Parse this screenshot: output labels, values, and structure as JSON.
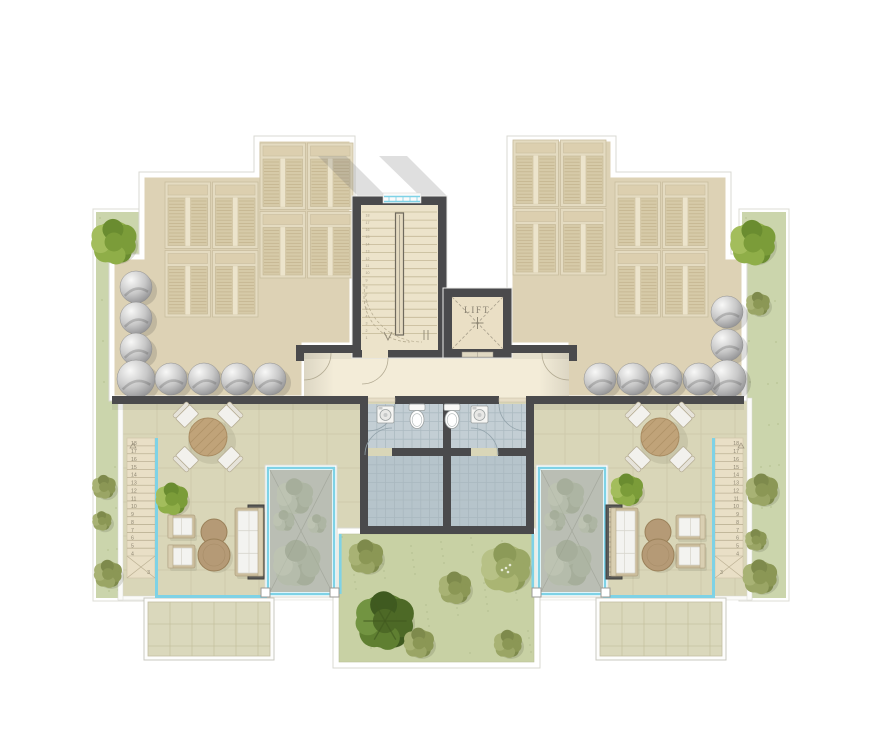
{
  "plan": {
    "lift": {
      "label": "LIFT"
    },
    "stairs": {
      "outer_left_steps": [
        "18",
        "17",
        "16",
        "15",
        "14",
        "13",
        "12",
        "11",
        "10",
        "9",
        "8",
        "7",
        "6",
        "5",
        "4"
      ],
      "outer_left_landing": "3",
      "outer_right_steps": [
        "18",
        "17",
        "16",
        "15",
        "14",
        "13",
        "12",
        "11",
        "10",
        "9",
        "8",
        "7",
        "6",
        "5",
        "4"
      ],
      "outer_right_landing": "3",
      "tower_steps": [
        "1",
        "2",
        "3",
        "4",
        "5",
        "6",
        "7",
        "8",
        "9",
        "10",
        "11",
        "12",
        "13",
        "14",
        "15",
        "16",
        "17",
        "18"
      ]
    },
    "summary": {
      "dome_skylights_left": 8,
      "dome_skylights_right": 7,
      "louver_skylight_clusters": 4,
      "terraces": 2,
      "bathrooms": 2,
      "garden_trees": 6
    }
  },
  "colors": {
    "wall": "#4a4a4c",
    "roof_deck": "#ddd2b5",
    "louver_panel": "#d6caa8",
    "terrace_tile": "#d9d6b8",
    "corridor": "#f3ecd8",
    "stair_tread": "#e9dfc6",
    "grass_strip": "#cbd5ac",
    "grass_garden": "#c8d1a4",
    "bath_tile_upper": "#c3ced4",
    "bath_tile_lower": "#b6c4cb",
    "glass_rail": "#7ed2e6",
    "courtyard_glass": "#babeb4",
    "dome_gray": "#8e8e90",
    "table_wood": "#c0a379",
    "pouf_tan": "#b59a76",
    "furniture_frame": "#cbbd9c",
    "white_parapet": "#ffffff"
  }
}
